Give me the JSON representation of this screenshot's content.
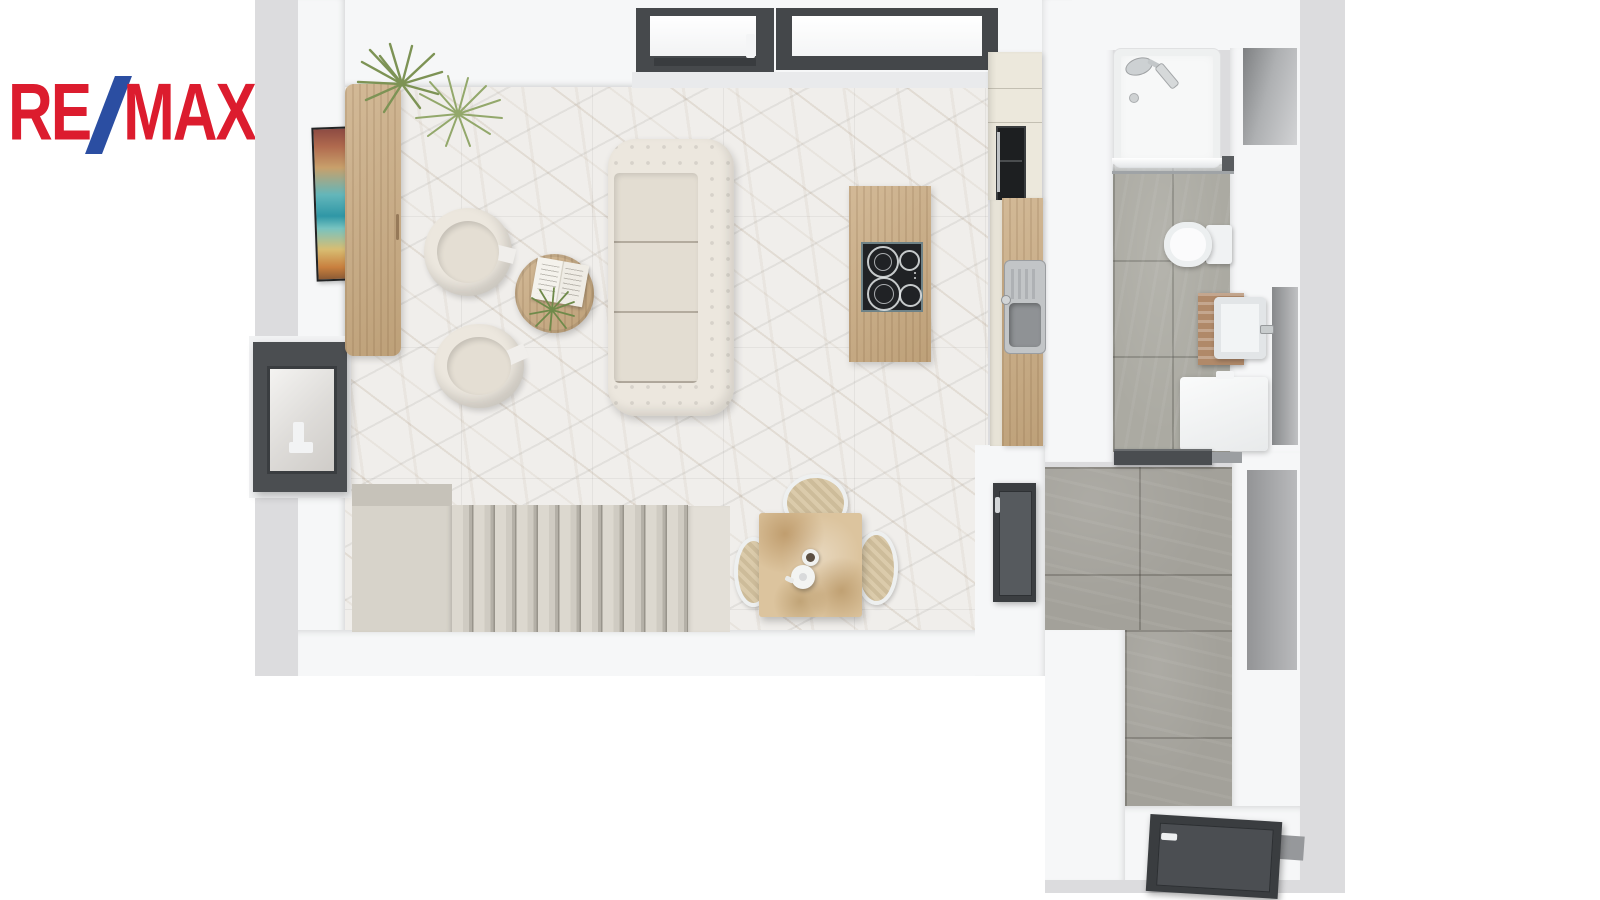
{
  "brand": {
    "left": "RE",
    "slash": "/",
    "right": "MAX",
    "red": "#DC1C2E",
    "blue": "#2B4EA2"
  },
  "palette": {
    "page_background": "#ffffff",
    "plan_backdrop": "#dcdcde",
    "wall": "#f6f7f8",
    "marble_floor": "#f0eeeb",
    "hallway_tile": "#a3a19a",
    "bathroom_tile": "#abaaa2",
    "wood_light": "#c9aa80",
    "wood_rustic_table": "#dcc49e",
    "dark_window_frame": "#46494c",
    "cream_upholstery": "#ece7de",
    "cream_cabinet": "#ece8dc",
    "stair_beige": "#d5d1c8",
    "chrome": "#c3c7ca",
    "cooktop_black": "#202225",
    "plant_green": "#7d9355"
  },
  "legend": {
    "rooms": [
      "living-room",
      "kitchen",
      "bathroom",
      "hallway",
      "staircase"
    ],
    "furniture": [
      "sideboard",
      "potted-plant",
      "wall-art",
      "round-armchair-1",
      "round-armchair-2",
      "coffee-table",
      "open-book",
      "chesterfield-sofa",
      "kitchen-island",
      "induction-cooktop",
      "tall-cabinet-with-oven",
      "counter-with-sink",
      "dining-table",
      "dining-chairs",
      "teapot",
      "cup",
      "bathtub-shower",
      "glass-screen",
      "toilet",
      "vanity-sink",
      "washing-machine",
      "skylight-left",
      "skylight-right",
      "casement-window",
      "hall-door",
      "bathroom-door",
      "entry-door"
    ]
  }
}
